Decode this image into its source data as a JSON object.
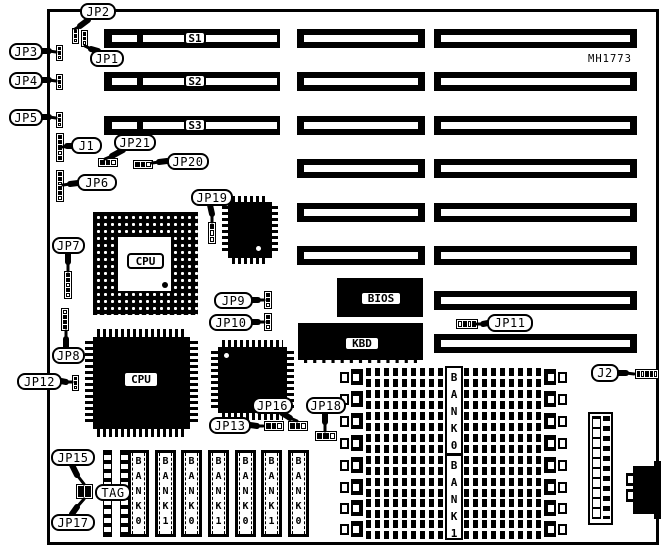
{
  "part_number": {
    "text": "MH1773",
    "x": 588,
    "y": 53,
    "w": 54,
    "h": 12
  },
  "colors": {
    "ink": "#000000",
    "paper": "#ffffff"
  },
  "board": {
    "x": 47,
    "y": 9,
    "w": 612,
    "h": 536
  },
  "slots": {
    "geometry": {
      "left": {
        "x": 104,
        "w": 176
      },
      "mid": {
        "x": 297,
        "w": 128
      },
      "right": {
        "x": 434,
        "w": 203
      },
      "h": 19,
      "short_stripe": {
        "dx": 8,
        "w": 25
      },
      "long_stripe": {
        "dx": 39,
        "w": 134
      }
    },
    "rows": [
      {
        "y": 29,
        "label": "S1",
        "segs": [
          "left",
          "mid",
          "right"
        ]
      },
      {
        "y": 72,
        "label": "S2",
        "segs": [
          "left",
          "mid",
          "right"
        ]
      },
      {
        "y": 116,
        "label": "S3",
        "segs": [
          "left",
          "mid",
          "right"
        ]
      },
      {
        "y": 159,
        "label": "",
        "segs": [
          "mid",
          "right"
        ]
      },
      {
        "y": 203,
        "label": "",
        "segs": [
          "mid",
          "right"
        ]
      },
      {
        "y": 246,
        "label": "",
        "segs": [
          "mid",
          "right"
        ]
      },
      {
        "y": 291,
        "label": "",
        "segs": [
          "right"
        ]
      },
      {
        "y": 334,
        "label": "",
        "segs": [
          "right"
        ]
      }
    ],
    "label_box": {
      "x": 184,
      "dy": 2,
      "w": 22,
      "h": 14
    }
  },
  "chips": [
    {
      "id": "bios-rom",
      "label": "BIOS",
      "x": 337,
      "y": 278,
      "w": 86,
      "h": 39,
      "label_box": [
        360,
        291,
        42,
        15
      ]
    },
    {
      "id": "kbd-controller",
      "label": "KBD",
      "x": 298,
      "y": 323,
      "w": 125,
      "h": 40,
      "label_box": [
        344,
        336,
        36,
        15
      ],
      "dashed_bottom": true
    },
    {
      "id": "cpu-socket-pga",
      "label": "CPU",
      "x": 93,
      "y": 212,
      "w": 105,
      "h": 103,
      "pga": true,
      "inner": [
        25,
        25,
        53,
        54
      ],
      "label_box": [
        127,
        253,
        37,
        16
      ],
      "dot_black": [
        162,
        282,
        6,
        6
      ]
    },
    {
      "id": "cpu-qfp",
      "label": "CPU",
      "x": 93,
      "y": 337,
      "w": 97,
      "h": 92,
      "pins": 8,
      "label_box": [
        123,
        371,
        36,
        17
      ]
    },
    {
      "id": "qfp-small-upper",
      "label": "",
      "x": 228,
      "y": 202,
      "w": 44,
      "h": 56,
      "pins": 6,
      "dot_white": [
        256,
        246,
        5,
        5
      ]
    },
    {
      "id": "qfp-small-lower",
      "label": "",
      "x": 218,
      "y": 347,
      "w": 69,
      "h": 66,
      "pins": 7,
      "dot_white": [
        224,
        353,
        5,
        5
      ]
    }
  ],
  "jumpers": [
    {
      "id": "jp2-header",
      "o": "v",
      "x": 72,
      "y": 28,
      "w": 7,
      "h": 16,
      "cells": [
        1,
        1,
        0
      ]
    },
    {
      "id": "jp1-header",
      "o": "v",
      "x": 81,
      "y": 30,
      "w": 7,
      "h": 17,
      "cells": [
        1,
        1,
        0
      ]
    },
    {
      "id": "jp3-header",
      "o": "v",
      "x": 56,
      "y": 45,
      "w": 7,
      "h": 16,
      "cells": [
        1,
        1,
        0
      ]
    },
    {
      "id": "jp4-header",
      "o": "v",
      "x": 56,
      "y": 74,
      "w": 7,
      "h": 16,
      "cells": [
        1,
        1,
        0
      ]
    },
    {
      "id": "jp5-header",
      "o": "v",
      "x": 56,
      "y": 112,
      "w": 7,
      "h": 16,
      "cells": [
        1,
        1,
        0
      ]
    },
    {
      "id": "j1-header",
      "o": "v",
      "x": 56,
      "y": 133,
      "w": 8,
      "h": 29,
      "cells": [
        1,
        1,
        1,
        0,
        1
      ]
    },
    {
      "id": "jp6-header",
      "o": "v",
      "x": 56,
      "y": 170,
      "w": 8,
      "h": 32,
      "cells": [
        1,
        1,
        0,
        1,
        1,
        0
      ]
    },
    {
      "id": "jp21-header",
      "o": "h",
      "x": 98,
      "y": 158,
      "w": 20,
      "h": 9,
      "cells": [
        1,
        1,
        0
      ]
    },
    {
      "id": "jp20-header",
      "o": "h",
      "x": 133,
      "y": 160,
      "w": 20,
      "h": 9,
      "cells": [
        1,
        1,
        0
      ]
    },
    {
      "id": "jp19-header",
      "o": "v",
      "x": 208,
      "y": 222,
      "w": 8,
      "h": 22,
      "cells": [
        1,
        0,
        0
      ]
    },
    {
      "id": "jp7-header",
      "o": "v",
      "x": 64,
      "y": 271,
      "w": 8,
      "h": 28,
      "cells": [
        1,
        1,
        0,
        1,
        0
      ]
    },
    {
      "id": "jp8-header",
      "o": "v",
      "x": 61,
      "y": 308,
      "w": 8,
      "h": 23,
      "cells": [
        0,
        1,
        1,
        1
      ]
    },
    {
      "id": "jp12-header",
      "o": "v",
      "x": 72,
      "y": 375,
      "w": 7,
      "h": 16,
      "cells": [
        1,
        1,
        0
      ]
    },
    {
      "id": "jp9-header",
      "o": "v",
      "x": 264,
      "y": 291,
      "w": 8,
      "h": 18,
      "cells": [
        1,
        1,
        0
      ]
    },
    {
      "id": "jp10-header",
      "o": "v",
      "x": 264,
      "y": 313,
      "w": 8,
      "h": 18,
      "cells": [
        1,
        1,
        0
      ]
    },
    {
      "id": "jp11-header",
      "o": "h",
      "x": 456,
      "y": 319,
      "w": 22,
      "h": 10,
      "cells": [
        0,
        1,
        0,
        1
      ]
    },
    {
      "id": "jp13-header",
      "o": "h",
      "x": 264,
      "y": 421,
      "w": 20,
      "h": 10,
      "cells": [
        1,
        1,
        0
      ]
    },
    {
      "id": "jp16-header",
      "o": "h",
      "x": 288,
      "y": 421,
      "w": 20,
      "h": 10,
      "cells": [
        1,
        1,
        0
      ]
    },
    {
      "id": "jp18-header",
      "o": "h",
      "x": 315,
      "y": 431,
      "w": 22,
      "h": 10,
      "cells": [
        1,
        1,
        0
      ]
    },
    {
      "id": "jp15-block",
      "o": "h",
      "x": 76,
      "y": 484,
      "w": 17,
      "h": 15,
      "cells": [
        1,
        1
      ]
    },
    {
      "id": "j2-header",
      "o": "h",
      "x": 635,
      "y": 369,
      "w": 24,
      "h": 10,
      "cells": [
        1,
        0,
        1,
        1,
        0
      ]
    }
  ],
  "callouts": [
    {
      "label": "JP2",
      "box": [
        80,
        3,
        36,
        17
      ],
      "tail": [
        [
          88,
          20
        ],
        [
          80,
          26
        ],
        [
          75,
          29
        ]
      ]
    },
    {
      "label": "JP1",
      "box": [
        90,
        50,
        34,
        17
      ],
      "tail": [
        [
          98,
          51
        ],
        [
          91,
          49
        ],
        [
          85,
          46
        ]
      ]
    },
    {
      "label": "JP3",
      "box": [
        9,
        43,
        34,
        17
      ],
      "tail": [
        [
          42,
          51
        ],
        [
          49,
          51
        ],
        [
          56,
          52
        ]
      ]
    },
    {
      "label": "JP4",
      "box": [
        9,
        72,
        34,
        17
      ],
      "tail": [
        [
          42,
          80
        ],
        [
          49,
          80
        ],
        [
          56,
          81
        ]
      ]
    },
    {
      "label": "JP5",
      "box": [
        9,
        109,
        34,
        17
      ],
      "tail": [
        [
          42,
          117
        ],
        [
          49,
          117
        ],
        [
          56,
          118
        ]
      ]
    },
    {
      "label": "J1",
      "box": [
        71,
        137,
        31,
        17
      ],
      "tail": [
        [
          72,
          146
        ],
        [
          67,
          146
        ],
        [
          63,
          147
        ]
      ]
    },
    {
      "label": "JP21",
      "box": [
        114,
        134,
        42,
        17
      ],
      "tail": [
        [
          123,
          150
        ],
        [
          112,
          156
        ],
        [
          105,
          159
        ]
      ]
    },
    {
      "label": "JP20",
      "box": [
        167,
        153,
        42,
        17
      ],
      "tail": [
        [
          167,
          161
        ],
        [
          159,
          162
        ],
        [
          152,
          163
        ]
      ]
    },
    {
      "label": "JP6",
      "box": [
        77,
        174,
        40,
        17
      ],
      "tail": [
        [
          78,
          183
        ],
        [
          70,
          184
        ],
        [
          63,
          185
        ]
      ]
    },
    {
      "label": "JP19",
      "box": [
        191,
        189,
        42,
        17
      ],
      "tail": [
        [
          210,
          205
        ],
        [
          212,
          214
        ],
        [
          212,
          222
        ]
      ]
    },
    {
      "label": "JP7",
      "box": [
        52,
        237,
        33,
        17
      ],
      "tail": [
        [
          68,
          253
        ],
        [
          68,
          262
        ],
        [
          68,
          271
        ]
      ]
    },
    {
      "label": "JP8",
      "box": [
        52,
        347,
        33,
        17
      ],
      "tail": [
        [
          66,
          347
        ],
        [
          66,
          339
        ],
        [
          66,
          331
        ]
      ]
    },
    {
      "label": "JP12",
      "box": [
        17,
        373,
        45,
        17
      ],
      "tail": [
        [
          61,
          381
        ],
        [
          66,
          382
        ],
        [
          72,
          382
        ]
      ]
    },
    {
      "label": "JP9",
      "box": [
        214,
        292,
        39,
        17
      ],
      "tail": [
        [
          252,
          300
        ],
        [
          258,
          300
        ],
        [
          264,
          300
        ]
      ]
    },
    {
      "label": "JP10",
      "box": [
        209,
        314,
        44,
        17
      ],
      "tail": [
        [
          252,
          322
        ],
        [
          258,
          322
        ],
        [
          264,
          322
        ]
      ]
    },
    {
      "label": "JP11",
      "box": [
        487,
        314,
        46,
        18
      ],
      "tail": [
        [
          488,
          323
        ],
        [
          483,
          324
        ],
        [
          477,
          324
        ]
      ]
    },
    {
      "label": "JP13",
      "box": [
        209,
        417,
        42,
        17
      ],
      "tail": [
        [
          250,
          425
        ],
        [
          257,
          426
        ],
        [
          263,
          426
        ]
      ]
    },
    {
      "label": "JP16",
      "box": [
        252,
        397,
        41,
        17
      ],
      "tail": [
        [
          282,
          413
        ],
        [
          290,
          418
        ],
        [
          297,
          421
        ]
      ]
    },
    {
      "label": "JP18",
      "box": [
        306,
        397,
        40,
        17
      ],
      "tail": [
        [
          325,
          413
        ],
        [
          325,
          422
        ],
        [
          325,
          431
        ]
      ]
    },
    {
      "label": "JP15",
      "box": [
        51,
        449,
        44,
        17
      ],
      "tail": [
        [
          72,
          465
        ],
        [
          77,
          475
        ],
        [
          84,
          484
        ]
      ]
    },
    {
      "label": "JP17",
      "box": [
        51,
        514,
        44,
        17
      ],
      "tail": [
        [
          72,
          514
        ],
        [
          77,
          507
        ],
        [
          84,
          499
        ]
      ]
    },
    {
      "label": "J2",
      "box": [
        591,
        364,
        28,
        18
      ],
      "tail": [
        [
          618,
          373
        ],
        [
          626,
          373
        ],
        [
          634,
          374
        ]
      ]
    }
  ],
  "simm_vertical": {
    "y": 450,
    "h": 87,
    "w": 21,
    "xs": [
      128,
      155,
      181,
      208,
      235,
      261,
      288
    ],
    "labels": [
      "BANK0",
      "BANK1",
      "BANK0",
      "BANK1",
      "BANK0",
      "BANK1",
      "BANK0"
    ],
    "tag": {
      "x": 103,
      "w": 26,
      "label": "TAG",
      "label_box": [
        95,
        484,
        36,
        17
      ]
    }
  },
  "simm_horizontal": {
    "rows_y": [
      368,
      390,
      412,
      434,
      456,
      478,
      499,
      520
    ],
    "h": 19,
    "latch_left_x": 340,
    "comb1": [
      366,
      79
    ],
    "comb2": [
      464,
      78
    ],
    "latch_right_x": 544,
    "latch_w": 23,
    "banks": [
      {
        "label": "BANK0",
        "x": 445,
        "y": 366,
        "w": 18,
        "h": 89
      },
      {
        "label": "BANK1",
        "x": 445,
        "y": 454,
        "w": 18,
        "h": 86
      }
    ]
  },
  "connectors": {
    "power": {
      "id": "power-connector",
      "x": 588,
      "y": 412,
      "w": 25,
      "h": 113
    },
    "keyboard_din": {
      "id": "keyboard-din-connector",
      "x": 633,
      "y": 466,
      "w": 28,
      "h": 48,
      "tabs": [
        [
          626,
          473
        ],
        [
          626,
          489
        ]
      ],
      "steps": [
        [
          654,
          461,
          7,
          7
        ],
        [
          654,
          512,
          7,
          7
        ]
      ]
    }
  }
}
